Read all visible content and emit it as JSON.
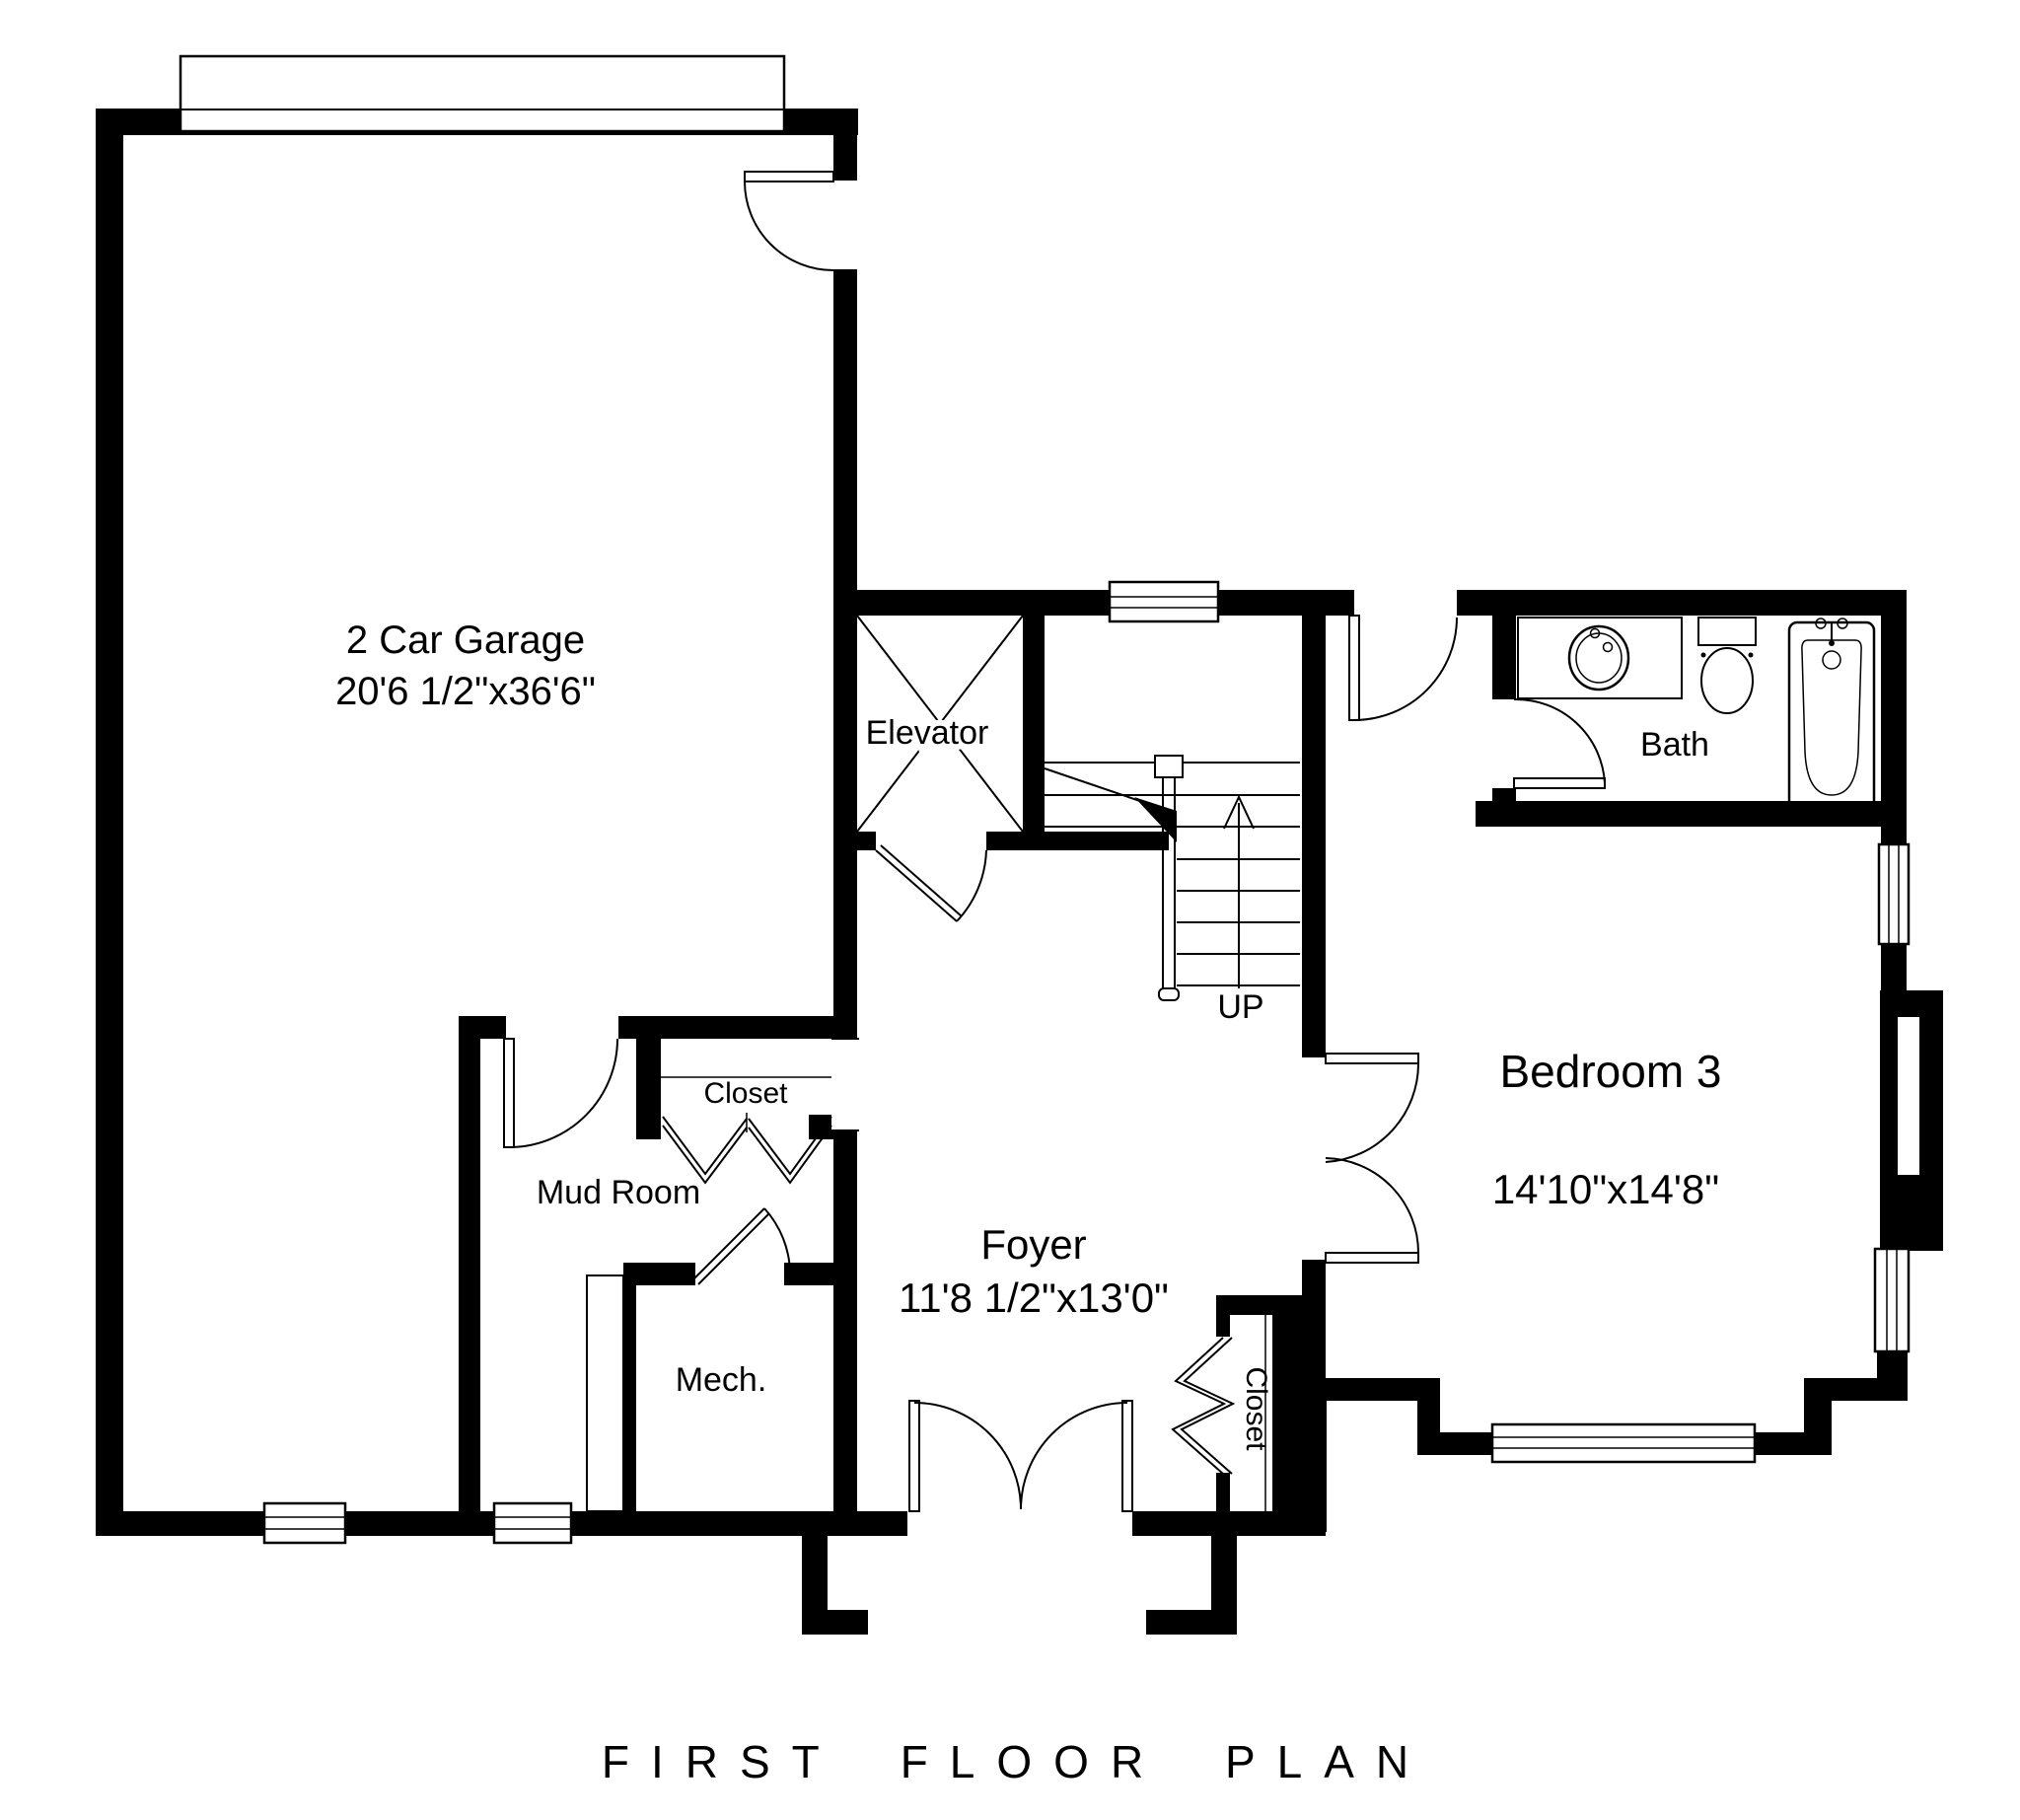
{
  "title": "FIRST FLOOR PLAN",
  "rooms": {
    "garage": {
      "label": "2 Car Garage",
      "dims": "20'6 1/2\"x36'6\""
    },
    "elevator": {
      "label": "Elevator"
    },
    "stairs": {
      "label": "UP"
    },
    "bath": {
      "label": "Bath"
    },
    "bedroom3": {
      "label": "Bedroom 3",
      "dims": "14'10\"x14'8\""
    },
    "mud_room": {
      "label": "Mud Room"
    },
    "mud_closet": {
      "label": "Closet"
    },
    "mech": {
      "label": "Mech."
    },
    "foyer": {
      "label": "Foyer",
      "dims": "11'8 1/2\"x13'0\""
    },
    "foyer_closet": {
      "label": "Closet"
    }
  },
  "colors": {
    "wall": "#000000",
    "background": "#ffffff",
    "line": "#000000"
  }
}
